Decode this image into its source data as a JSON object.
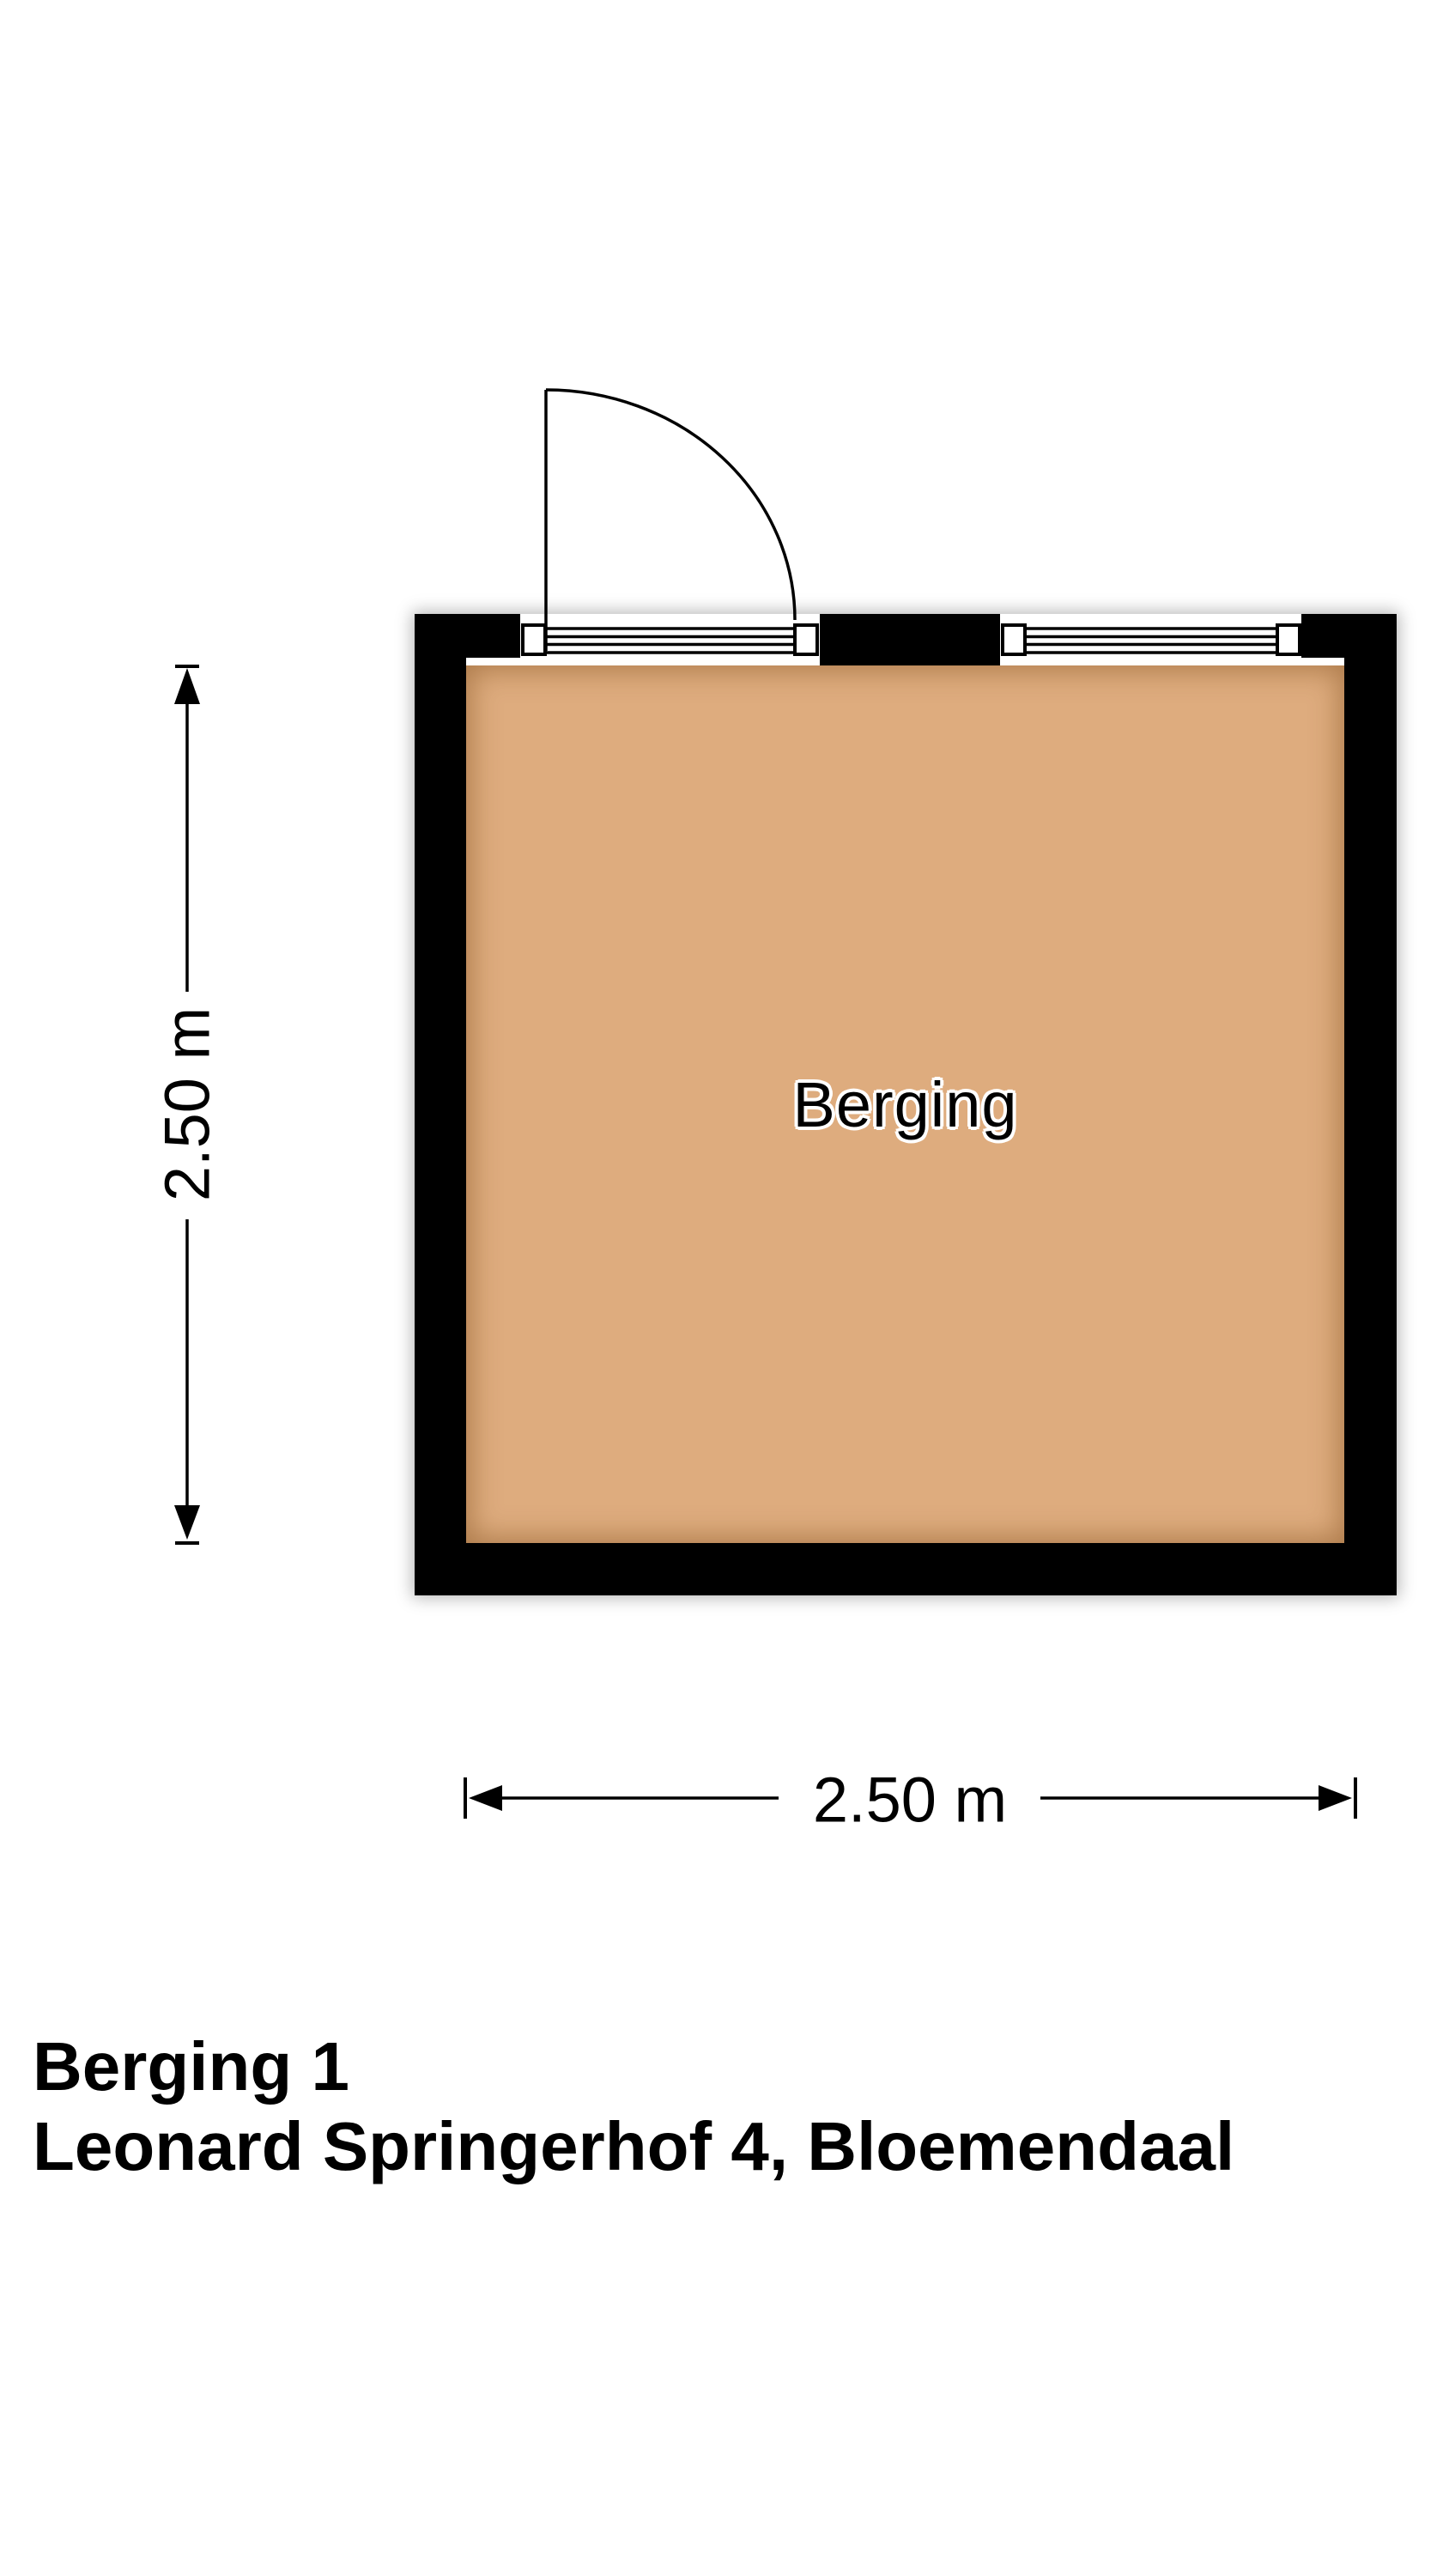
{
  "plan": {
    "room_label": "Berging",
    "vertical_dimension": "2.50 m",
    "horizontal_dimension": "2.50 m"
  },
  "footer": {
    "title": "Berging 1",
    "address": "Leonard Springerhof 4, Bloemendaal"
  },
  "colors": {
    "background": "#ffffff",
    "wall": "#000000",
    "floor": "#deac7e",
    "line": "#000000",
    "label": "#000000"
  }
}
